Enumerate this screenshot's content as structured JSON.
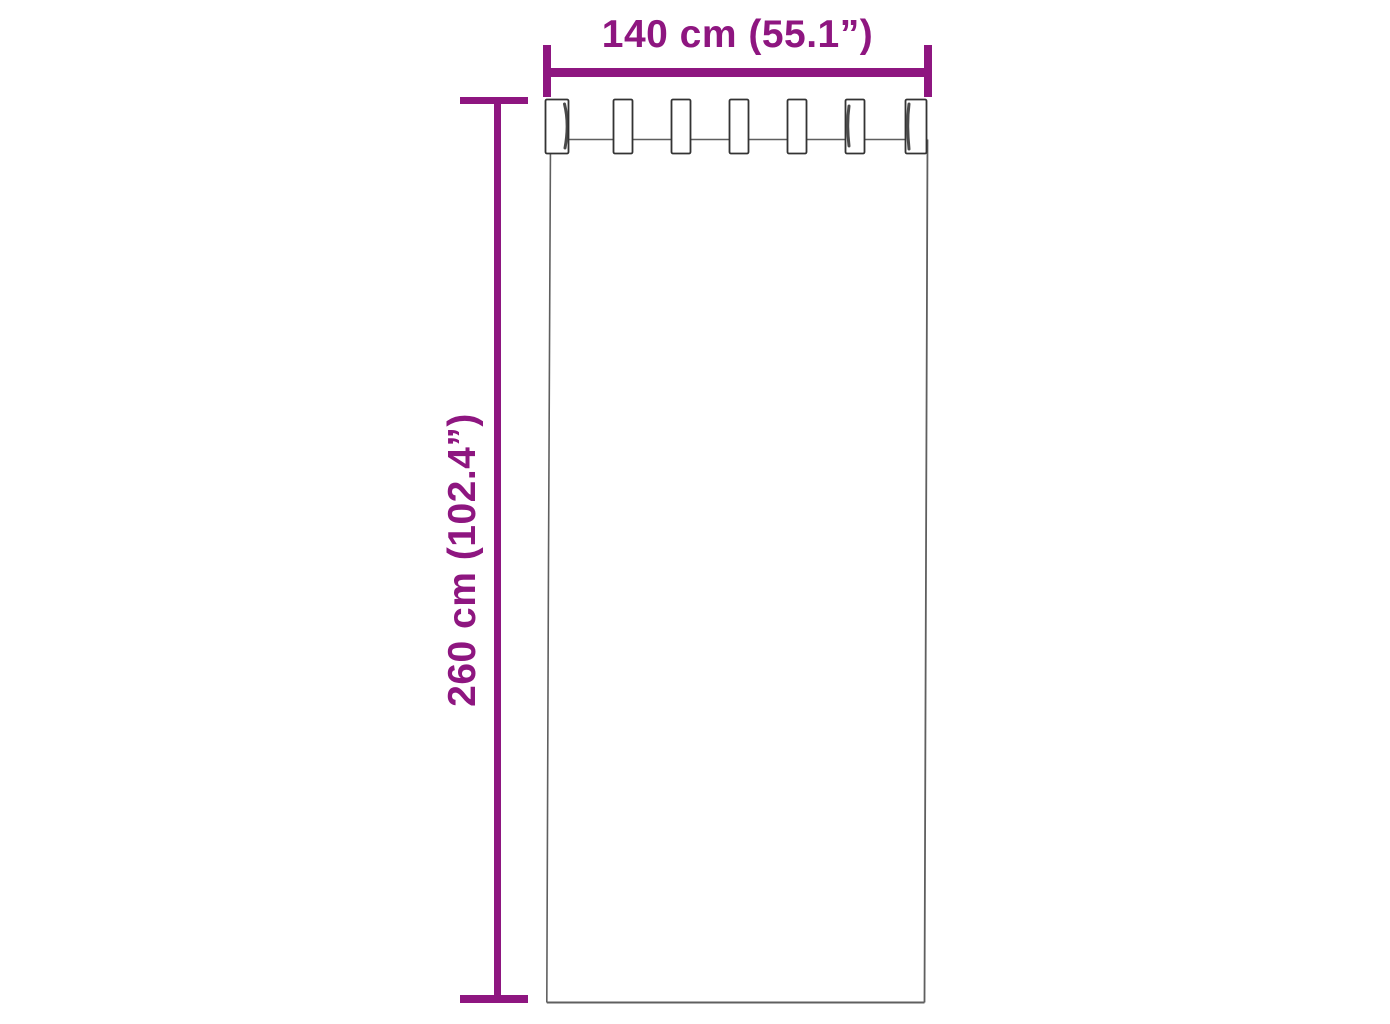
{
  "diagram": {
    "kind": "product-dimension-diagram",
    "subject": "tab-top curtain panel, front view",
    "tab_count": 7,
    "width_dimension": {
      "label": "140 cm (55.1”)",
      "value_cm": 140,
      "value_inches": 55.1
    },
    "height_dimension": {
      "label": "260 cm (102.4”)",
      "value_cm": 260,
      "value_inches": 102.4
    },
    "colors": {
      "dimension_accent": "#8E1680",
      "curtain_outline": "#5f5f5f",
      "tab_outline": "#333333",
      "background": "#ffffff"
    }
  }
}
